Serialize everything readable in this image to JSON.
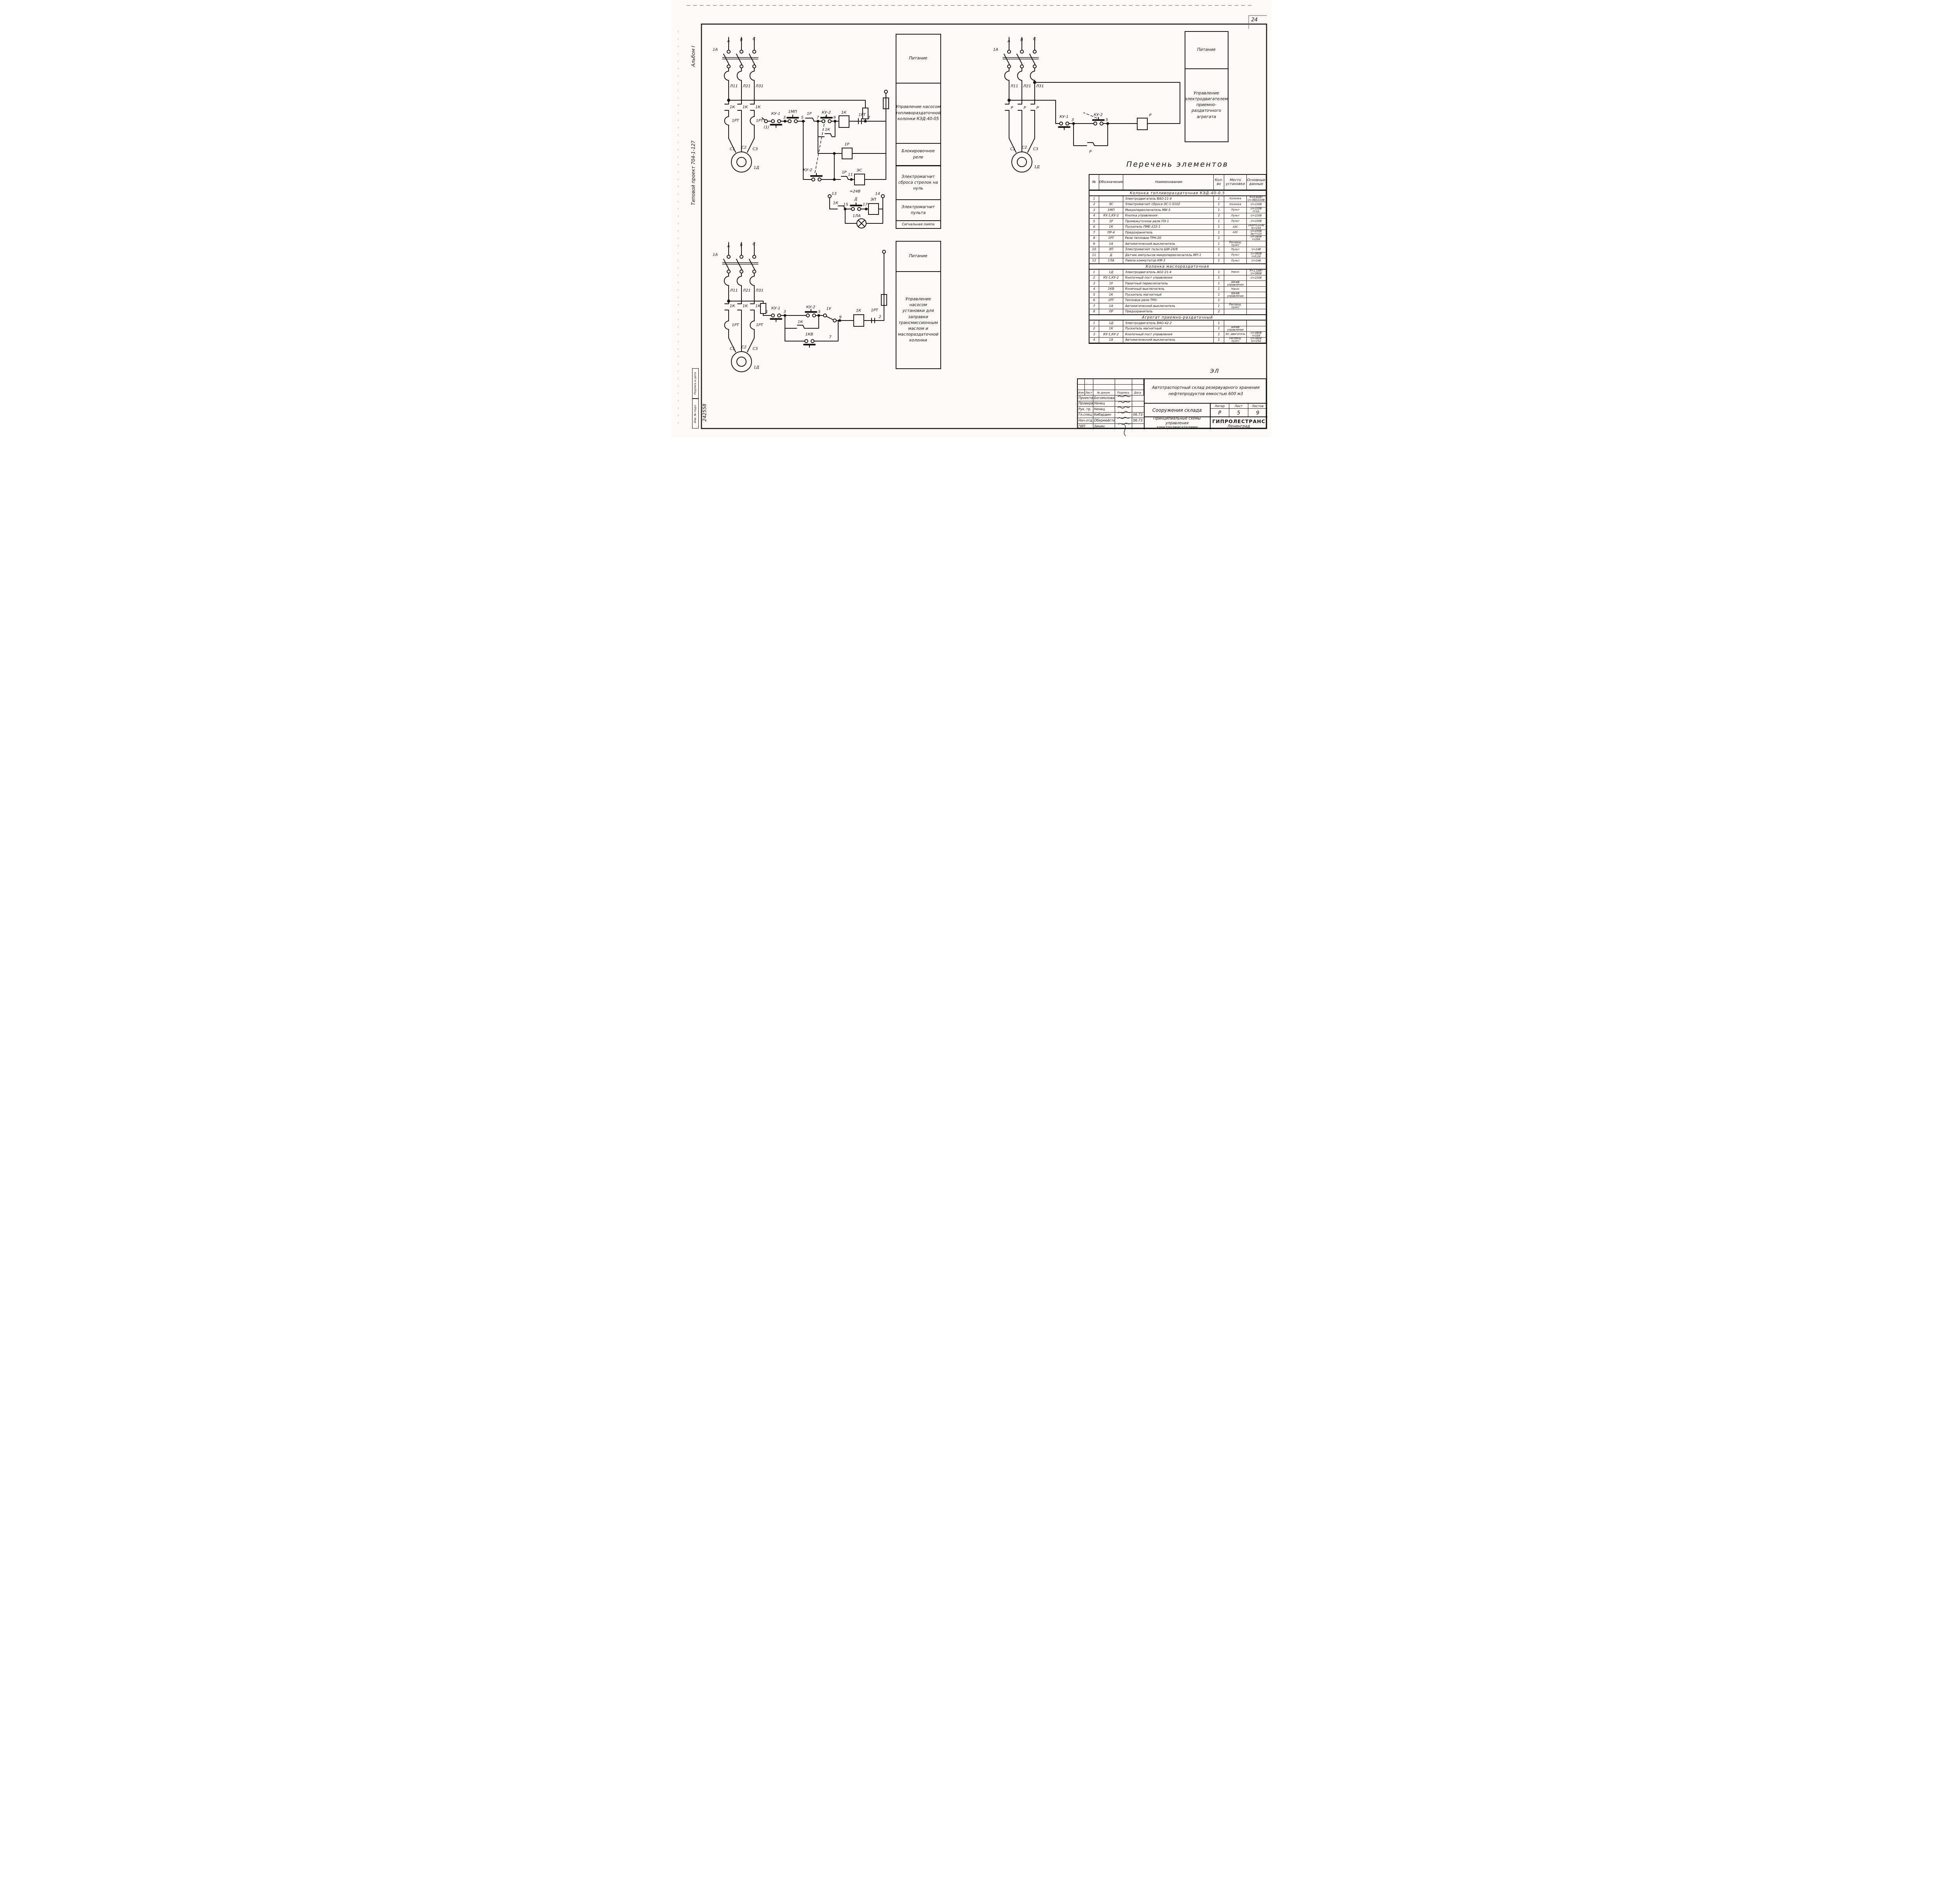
{
  "page": {
    "corner_number": "24",
    "doc_code": "ЭЛ"
  },
  "margins": {
    "album": "Альбом I",
    "project": "Типовой проект 704-1-127",
    "signature_label": "Подпись и дата",
    "inventory_label": "Инв. № подл.",
    "inventory_number": "242558"
  },
  "panels": {
    "fuel": [
      "Питание",
      "Управление насосом топливораздаточной колонки КЭД-40-05",
      "Блокировочное реле",
      "Электромагнит сброса стрелок на нуль",
      "Электромагнит пульта",
      "Сигнальная лампа"
    ],
    "oil": [
      "Питание",
      "Управление насосом установки для заправки трансмиссионным маслом и маслораздаточной колонки"
    ],
    "agg": [
      "Питание",
      "Управление электродвигателем приемно-раздаточного агрегата"
    ]
  },
  "schematic_labels": {
    "fuel": [
      [
        "А",
        148,
        106
      ],
      [
        "В",
        181,
        103
      ],
      [
        "С",
        214,
        101
      ],
      [
        "1А",
        114,
        128
      ],
      [
        "Л11",
        162,
        222
      ],
      [
        "Л21",
        195,
        222
      ],
      [
        "Л31",
        228,
        222
      ],
      [
        "1К",
        158,
        276
      ],
      [
        "1К",
        191,
        276
      ],
      [
        "1К",
        224,
        276
      ],
      [
        "1РТ",
        166,
        311
      ],
      [
        "1РТ",
        228,
        311
      ],
      [
        "С1",
        158,
        384
      ],
      [
        "С2",
        188,
        380
      ],
      [
        "С3",
        217,
        384
      ],
      [
        "1Д",
        220,
        432
      ],
      [
        "(1)",
        246,
        328
      ],
      [
        "КУ-1",
        270,
        293
      ],
      [
        "3",
        292,
        303
      ],
      [
        "1МП",
        313,
        288
      ],
      [
        "5",
        338,
        303
      ],
      [
        "1Р",
        356,
        293
      ],
      [
        "7",
        378,
        303
      ],
      [
        "КУ-2",
        400,
        290
      ],
      [
        "9",
        421,
        303
      ],
      [
        "1К",
        445,
        290
      ],
      [
        "1РТ",
        492,
        296
      ],
      [
        "2",
        510,
        303
      ],
      [
        "1К",
        403,
        334
      ],
      [
        "1Р",
        453,
        372
      ],
      [
        "КУ-2",
        352,
        438
      ],
      [
        "1Р",
        446,
        444
      ],
      [
        "11",
        462,
        450
      ],
      [
        "ЭС",
        485,
        439
      ],
      [
        "13",
        420,
        499
      ],
      [
        "≈24В",
        474,
        493
      ],
      [
        "Д",
        476,
        513
      ],
      [
        "14",
        532,
        499
      ],
      [
        "1К",
        424,
        523
      ],
      [
        "15",
        450,
        527
      ],
      [
        "17",
        500,
        527
      ],
      [
        "ЭП",
        521,
        514
      ],
      [
        "1ЛА",
        478,
        556
      ]
    ],
    "oil": [
      [
        "А",
        148,
        634
      ],
      [
        "Б",
        181,
        631
      ],
      [
        "С",
        214,
        629
      ],
      [
        "1А",
        114,
        656
      ],
      [
        "Л11",
        162,
        748
      ],
      [
        "Л21",
        195,
        748
      ],
      [
        "Л31",
        228,
        748
      ],
      [
        "1К",
        158,
        788
      ],
      [
        "1К",
        191,
        788
      ],
      [
        "1К",
        224,
        788
      ],
      [
        "1РТ",
        166,
        837
      ],
      [
        "1РТ",
        228,
        837
      ],
      [
        "С1",
        158,
        898
      ],
      [
        "С2",
        188,
        894
      ],
      [
        "С3",
        217,
        898
      ],
      [
        "1Д",
        220,
        946
      ],
      [
        "1",
        247,
        803
      ],
      [
        "КУ-1",
        270,
        794
      ],
      [
        "3",
        293,
        803
      ],
      [
        "КУ-2",
        360,
        791
      ],
      [
        "5",
        382,
        803
      ],
      [
        "1У",
        406,
        795
      ],
      [
        "9",
        436,
        817
      ],
      [
        "1К",
        483,
        800
      ],
      [
        "1РТ",
        524,
        799
      ],
      [
        "2",
        538,
        816
      ],
      [
        "1К",
        333,
        829
      ],
      [
        "1КВ",
        356,
        861
      ],
      [
        "7",
        410,
        868
      ]
    ],
    "agg": [
      [
        "А",
        870,
        106
      ],
      [
        "В",
        903,
        103
      ],
      [
        "С",
        936,
        101
      ],
      [
        "1А",
        836,
        128
      ],
      [
        "Л11",
        884,
        222
      ],
      [
        "Л21",
        917,
        222
      ],
      [
        "Л31",
        950,
        222
      ],
      [
        "Р",
        878,
        278
      ],
      [
        "Р",
        911,
        278
      ],
      [
        "Р",
        944,
        278
      ],
      [
        "С1",
        880,
        384
      ],
      [
        "С2",
        910,
        380
      ],
      [
        "С3",
        939,
        384
      ],
      [
        "1Д",
        942,
        430
      ],
      [
        "КУ-1",
        1012,
        301
      ],
      [
        "3",
        1034,
        309
      ],
      [
        "КУ-2",
        1100,
        296
      ],
      [
        "5",
        1122,
        309
      ],
      [
        "Р",
        1234,
        297
      ],
      [
        "Р",
        1080,
        391
      ]
    ]
  },
  "parts_table": {
    "title": "Перечень элементов",
    "headers": [
      "№",
      "Обозначение",
      "Наименование",
      "Кол-во",
      "Место установки",
      "Основные данные"
    ],
    "sections": [
      {
        "name": "Колонка топливораздаточная КЭД-40-0.5",
        "rows": [
          [
            "1",
            "",
            "Электродвигатель ВАО-11-4",
            "1",
            "Колонка",
            "P=0,6кВт U=380/220В"
          ],
          [
            "2",
            "ЭС",
            "Электромагнит сброса ЭС-1-5102",
            "1",
            "Колонка",
            "U=220В"
          ],
          [
            "3",
            "1МП",
            "Микропереключатель МИ-3",
            "1",
            "Пульт",
            "U=220В I=1А"
          ],
          [
            "4",
            "КУ-1,КУ-2",
            "Кнопка управления",
            "2",
            "Пульт",
            "U=220В"
          ],
          [
            "5",
            "1Р",
            "Промежуточное реле ПЭ-1",
            "1",
            "Пульт",
            "U=220В"
          ],
          [
            "6",
            "1К",
            "Пускатель ПМЕ-222-1",
            "1",
            "АЗС",
            "Uкат=220В Iк=23А"
          ],
          [
            "7",
            "ПР-4",
            "Предохранитель",
            "1",
            "АЗС",
            "U=220В Iвст=2А"
          ],
          [
            "8",
            "1РТ",
            "Реле тепловое ТРН-20",
            "1",
            "",
            "U=380В I=20А"
          ],
          [
            "9",
            "1А",
            "Автоматический выключатель",
            "1",
            "Распред. пункт",
            ""
          ],
          [
            "10",
            "ЭП",
            "Электромагнит пульта ШИ-24/8",
            "1",
            "Пульт",
            "U=24В"
          ],
          [
            "11",
            "Д",
            "Датчик импульсов микропереключатель МП-1",
            "1",
            "Пульт",
            "U=380В I=0,2А"
          ],
          [
            "12",
            "1ЛА",
            "Лампа коммутатор КМ-3",
            "1",
            "Пульт",
            "U=24В"
          ]
        ]
      },
      {
        "name": "Колонка маслораздаточная",
        "rows": [
          [
            "1",
            "1Д",
            "Электродвигатель АО2-21-4",
            "1",
            "Насос",
            "P=1,1кВт U=380В"
          ],
          [
            "2",
            "КУ-1,КУ-2",
            "Кнопочный пост управления",
            "1",
            "",
            "U=220В"
          ],
          [
            "3",
            "1У",
            "Пакетный переключатель",
            "1",
            "Шкаф управления",
            ""
          ],
          [
            "4",
            "1КВ",
            "Конечный выключатель",
            "1",
            "Насос",
            ""
          ],
          [
            "5",
            "1К",
            "Пускатель магнитный",
            "1",
            "Шкаф управления",
            ""
          ],
          [
            "6",
            "1РТ",
            "Тепловое реле ТРН-",
            "1",
            "",
            ""
          ],
          [
            "7",
            "1А",
            "Автоматический выключатель",
            "1",
            "Распред. пункт",
            ""
          ],
          [
            "8",
            "ПР",
            "Предохранитель",
            "2",
            "",
            ""
          ]
        ]
      },
      {
        "name": "Агрегат приемно-раздаточный",
        "rows": [
          [
            "1",
            "1Д",
            "Электродвигатель ВАО-42-2",
            "1",
            "",
            ""
          ],
          [
            "2",
            "1К",
            "Пускатель магнитный",
            "1",
            "Шкаф управления",
            ""
          ],
          [
            "3",
            "КУ-1,КУ-2",
            "Кнопочный пост управления",
            "1",
            "Эл. двигатель",
            "U=380В I=10А"
          ],
          [
            "4",
            "1А",
            "Автоматический выключатель",
            "1",
            "Распред. пункт",
            "U=380В Iн=25А"
          ]
        ]
      }
    ]
  },
  "title_block": {
    "revision_headers": [
      "Изм",
      "Лист",
      "№ докум.",
      "Подпись",
      "Дата"
    ],
    "sig_rows": [
      {
        "role": "Проектир.",
        "name": "Богомолова",
        "date": ""
      },
      {
        "role": "Проверил",
        "name": "Ненец",
        "date": ""
      },
      {
        "role": "Рук. гр.",
        "name": "Ненец",
        "date": ""
      },
      {
        "role": "Гл.спец.",
        "name": "Кибардин",
        "date": "06.73"
      },
      {
        "role": "Нач.отд.",
        "name": "Обермейстер",
        "date": "06.73"
      },
      {
        "role": "ГИП",
        "name": "Зинин",
        "date": ""
      }
    ],
    "project": "Автотраспортный склад резервуарного хранения нефтепродуктов емкостью 600 м3",
    "object": "Сооружения склада",
    "liter_label": "Литер",
    "sheet_label": "Лист",
    "sheets_label": "Листов",
    "liter": "Р",
    "sheet": "5",
    "sheets": "9",
    "sheet_title": "Принципиальные схемы управления электродвигателями",
    "org": "ГИПРОЛЕСТРАНС",
    "org_city": "Ленинград"
  }
}
